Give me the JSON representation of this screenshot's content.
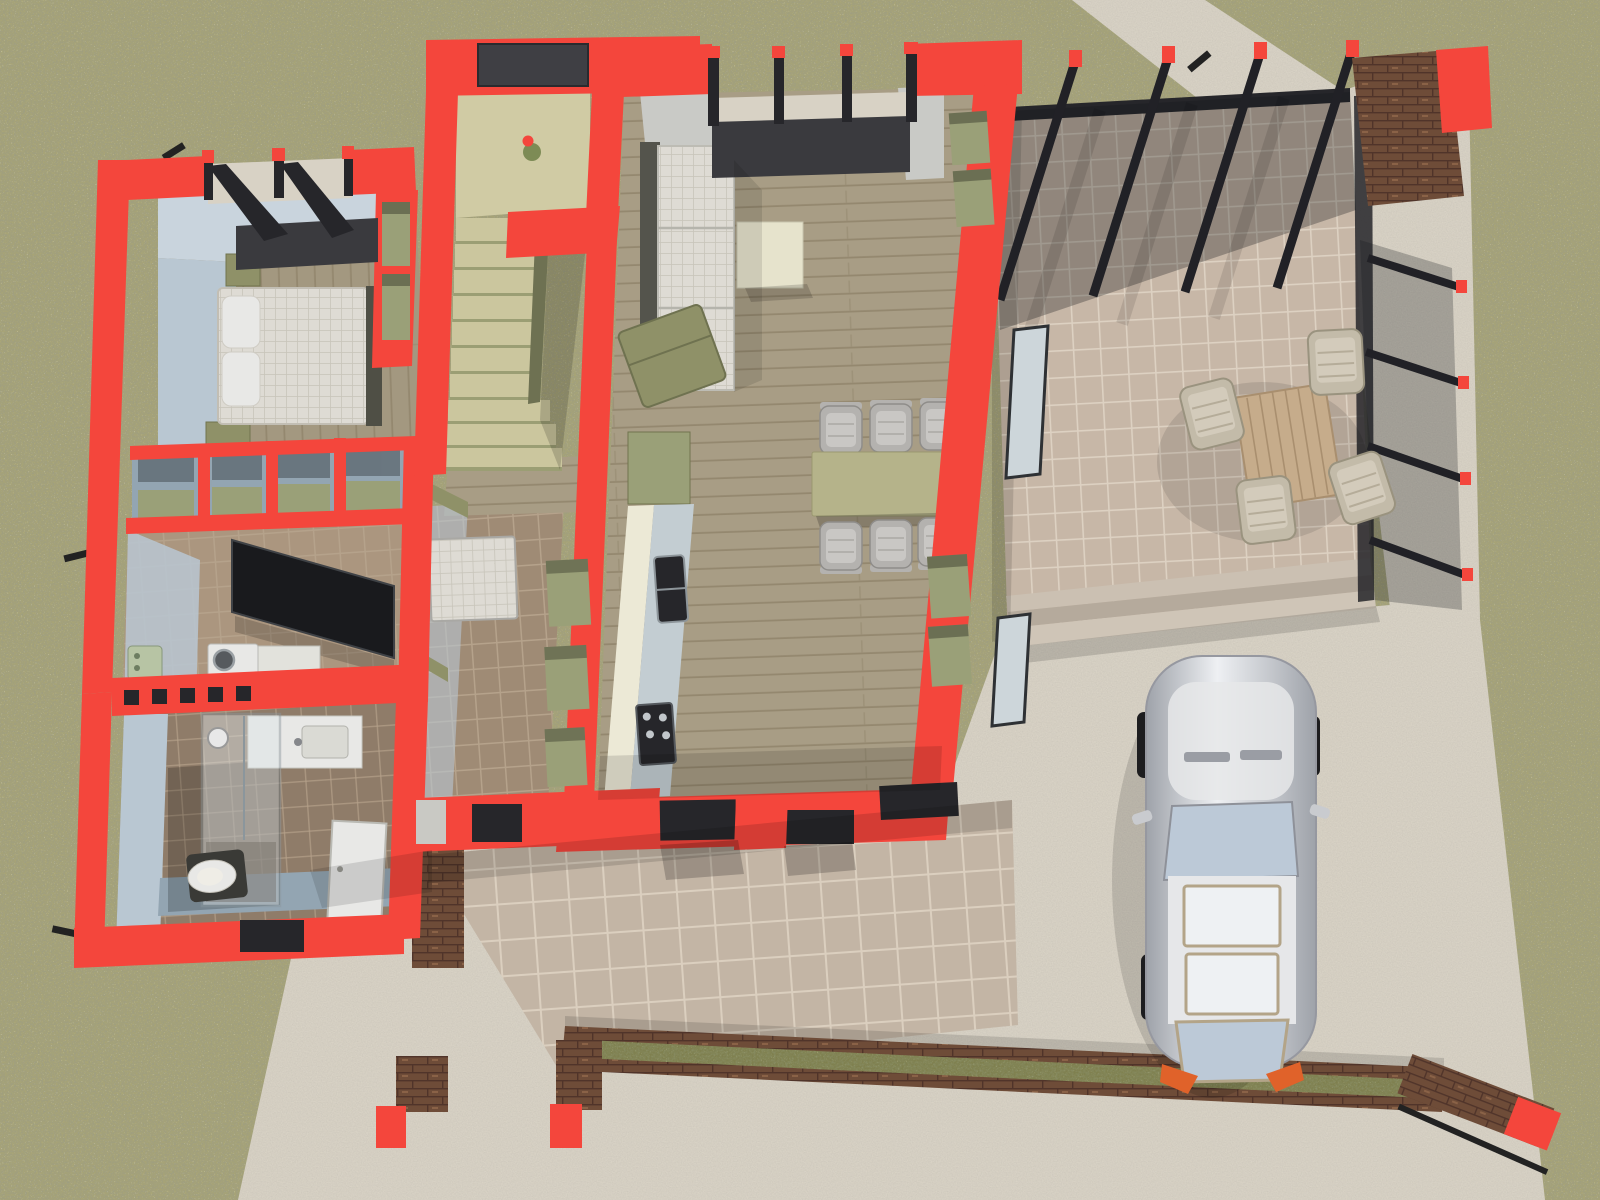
{
  "scene": {
    "description": "3D rendered cutaway floor plan of a single-storey house seen from above: red cut walls, bedroom with double bed, staircase, hallway, kitchen with counter, living-dining room with sofa and table for six, bathroom with shower and toilet, utility room, glazed pergola patio with outdoor dining set, front porch with brick planter, and a silver car parked on the driveway",
    "view": "top-down architectural visualization",
    "wall_cut_color_meaning": "bright red marks walls cut by the horizontal section plane"
  },
  "areas": [
    {
      "name": "bedroom",
      "features": [
        "double-bed",
        "pillows",
        "nightstands",
        "wardrobe-niches"
      ]
    },
    {
      "name": "closet-shelves",
      "features": [
        "shelf-cells"
      ]
    },
    {
      "name": "utility-room",
      "features": [
        "washing-machine",
        "boiler",
        "tilted-window-panel"
      ]
    },
    {
      "name": "bathroom",
      "features": [
        "shower-cabin",
        "sink-counter",
        "toilet",
        "glass-block-wall"
      ]
    },
    {
      "name": "staircase",
      "features": [
        "landing",
        "flower-pot",
        "steps"
      ]
    },
    {
      "name": "hallway",
      "features": [
        "bench",
        "wall-shelves",
        "entry-door",
        "white-door-panel"
      ]
    },
    {
      "name": "kitchen",
      "features": [
        "counter",
        "double-sink",
        "cooktop",
        "green-cabinet"
      ]
    },
    {
      "name": "living-dining-room",
      "features": [
        "sofa",
        "chaise",
        "coffee-table",
        "dining-table",
        "six-chairs",
        "window-wall",
        "shelf-niches"
      ]
    },
    {
      "name": "patio",
      "features": [
        "glass-pergola",
        "black-beams",
        "outdoor-table",
        "four-chairs",
        "steps",
        "brick-pillar"
      ]
    },
    {
      "name": "porch",
      "features": [
        "tiled-floor",
        "brick-planter",
        "plants",
        "brick-pillars"
      ]
    },
    {
      "name": "driveway",
      "features": [
        "silver-car",
        "brick-bench"
      ]
    },
    {
      "name": "yard",
      "features": [
        "grass",
        "concrete-walkways"
      ]
    }
  ],
  "colors": {
    "grass": "#a8a476",
    "grass_dark": "#5c5c42",
    "grass_light": "#d8d2a4",
    "concrete": "#d8d2c5",
    "concrete_shade": "#c2bcae",
    "patio_tile": "#c7b7a7",
    "patio_grout": "#ddd1c2",
    "porch_tile": "#c3b5a5",
    "porch_grout": "#dbcfbf",
    "hall_tile": "#9f8b75",
    "hall_grout": "#b5a28b",
    "util_tile": "#ab967f",
    "bath_tile": "#8f7c69",
    "wood": "#a89d85",
    "wood_line": "#94886f",
    "wood_bed": "#a39880",
    "red_wall": "#f4463c",
    "wall_blue": "#b9c7d2",
    "wall_blue_light": "#c9d4dd",
    "wall_blue_dark": "#93a5b2",
    "wall_grey": "#c9cac6",
    "dark_frame": "#26262a",
    "dark_sill": "#3a3a3e",
    "stair_tread": "#cbc69e",
    "stair_riser": "#9b9e74",
    "stair_side": "#6e7152",
    "landing": "#d0cba4",
    "olive": "#8f9168",
    "olive_light": "#9aa078",
    "olive_dark": "#71744e",
    "cream": "#ece9d6",
    "cream_table": "#e6e3cc",
    "counter_top": "#c3cdd2",
    "sofa": "#dcdbd4",
    "sofa_frame": "#54544c",
    "chair_grey": "#b4b2af",
    "chair_light": "#c9c7c4",
    "table_olive": "#b5b38a",
    "glass_pane": "#cdd6da",
    "white_goods": "#e8e8e6",
    "brick": "#6e4c38",
    "brick_dark": "#50342a",
    "brick_light": "#8a6247",
    "plant": "#7f8050",
    "mattress": "#dedbd4",
    "mattress_line": "#c8c4ba",
    "bed_frame": "#4f4f45",
    "boiler_green": "#b7c4a4",
    "outdoor_wood": "#c6ac8b",
    "outdoor_chair": "#c3bba9",
    "outdoor_chair_light": "#d3cbbb",
    "car_silver_hi": "#eef0f3",
    "car_silver": "#c6c9ce",
    "car_silver_dark": "#9ea2a9",
    "car_roof": "#e6e7e9",
    "car_glass": "#bcc9d7",
    "car_trim": "#b3a488",
    "car_orange": "#e0622a",
    "wheel": "#1d1d1f"
  }
}
